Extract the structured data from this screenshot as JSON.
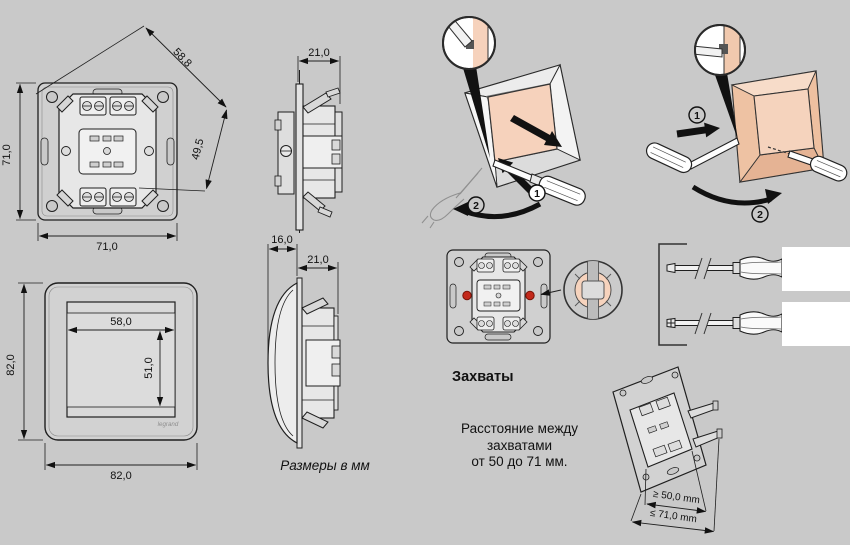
{
  "page": {
    "background": "#c9c9c9",
    "ink": "#1f1f1f",
    "accent_peach": "#f5d1ba",
    "accent_red": "#c3291b"
  },
  "mech_front": {
    "dim_left": "71,0",
    "dim_bottom": "71,0",
    "dim_diag": "58,8",
    "dim_right_diag": "49,5"
  },
  "mech_side": {
    "dim_top": "21,0"
  },
  "plate_front": {
    "dim_left": "82,0",
    "dim_bottom": "82,0",
    "dim_window_w": "58,0",
    "dim_window_h": "51,0",
    "brand": "legrand"
  },
  "switch_side": {
    "dim_front": "16,0",
    "dim_depth": "21,0"
  },
  "units_note": "Размеры в мм",
  "install_remove": {
    "step_1": "1",
    "step_2": "2"
  },
  "install_mount": {
    "step_1": "1",
    "step_2": "2"
  },
  "grips": {
    "label": "Захваты"
  },
  "distance_note": {
    "line_1": "Расстояние между",
    "line_2": "захватами",
    "line_3": "от 50 до 71 мм."
  },
  "mech_rear_3d": {
    "dim_grip_min": "≥ 50,0 mm",
    "dim_overall_max": "≤ 71,0 mm"
  }
}
